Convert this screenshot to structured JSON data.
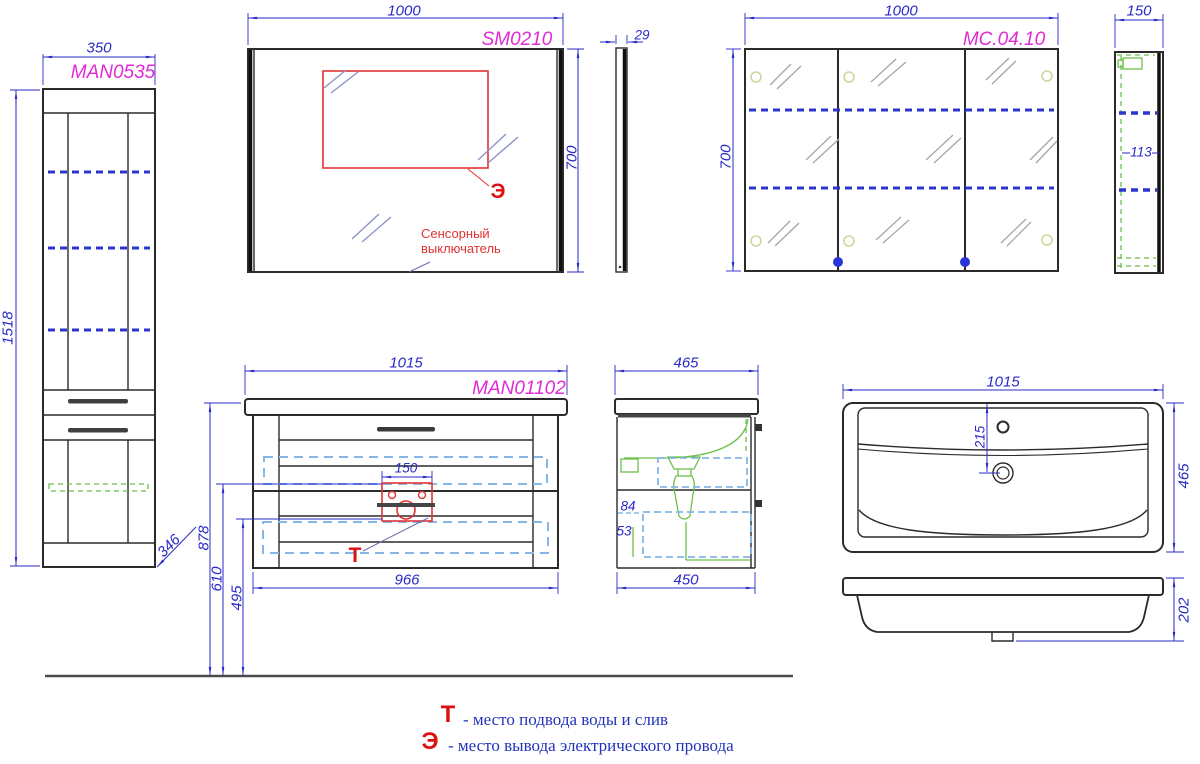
{
  "tall_cabinet": {
    "label": "MAN0535",
    "width": "350",
    "height": "1518",
    "depth": "346"
  },
  "mirror": {
    "label": "SM0210",
    "width": "1000",
    "height": "700",
    "thickness": "29",
    "symbol": "Э",
    "note_line1": "Сенсорный",
    "note_line2": "выключатель"
  },
  "mirror_cabinet": {
    "label": "МС.04.10",
    "width": "1000",
    "height": "700",
    "depth": "150",
    "shelf_spacing": "113"
  },
  "vanity": {
    "label": "MAN01102",
    "width": "1015",
    "bottom_width": "966",
    "height": "878",
    "drain_height": "610",
    "drain_bottom_height": "495",
    "cutout_width": "150",
    "symbol": "Т"
  },
  "vanity_side": {
    "depth": "465",
    "bottom_depth": "450",
    "dim_a": "84",
    "dim_b": "53"
  },
  "sink": {
    "width": "1015",
    "depth": "465",
    "drain_offset": "215",
    "height": "202"
  },
  "legend": {
    "water_symbol": "Т",
    "water_text": "- место подвода воды и слив",
    "electric_symbol": "Э",
    "electric_text": "- место вывода электрического провода"
  }
}
